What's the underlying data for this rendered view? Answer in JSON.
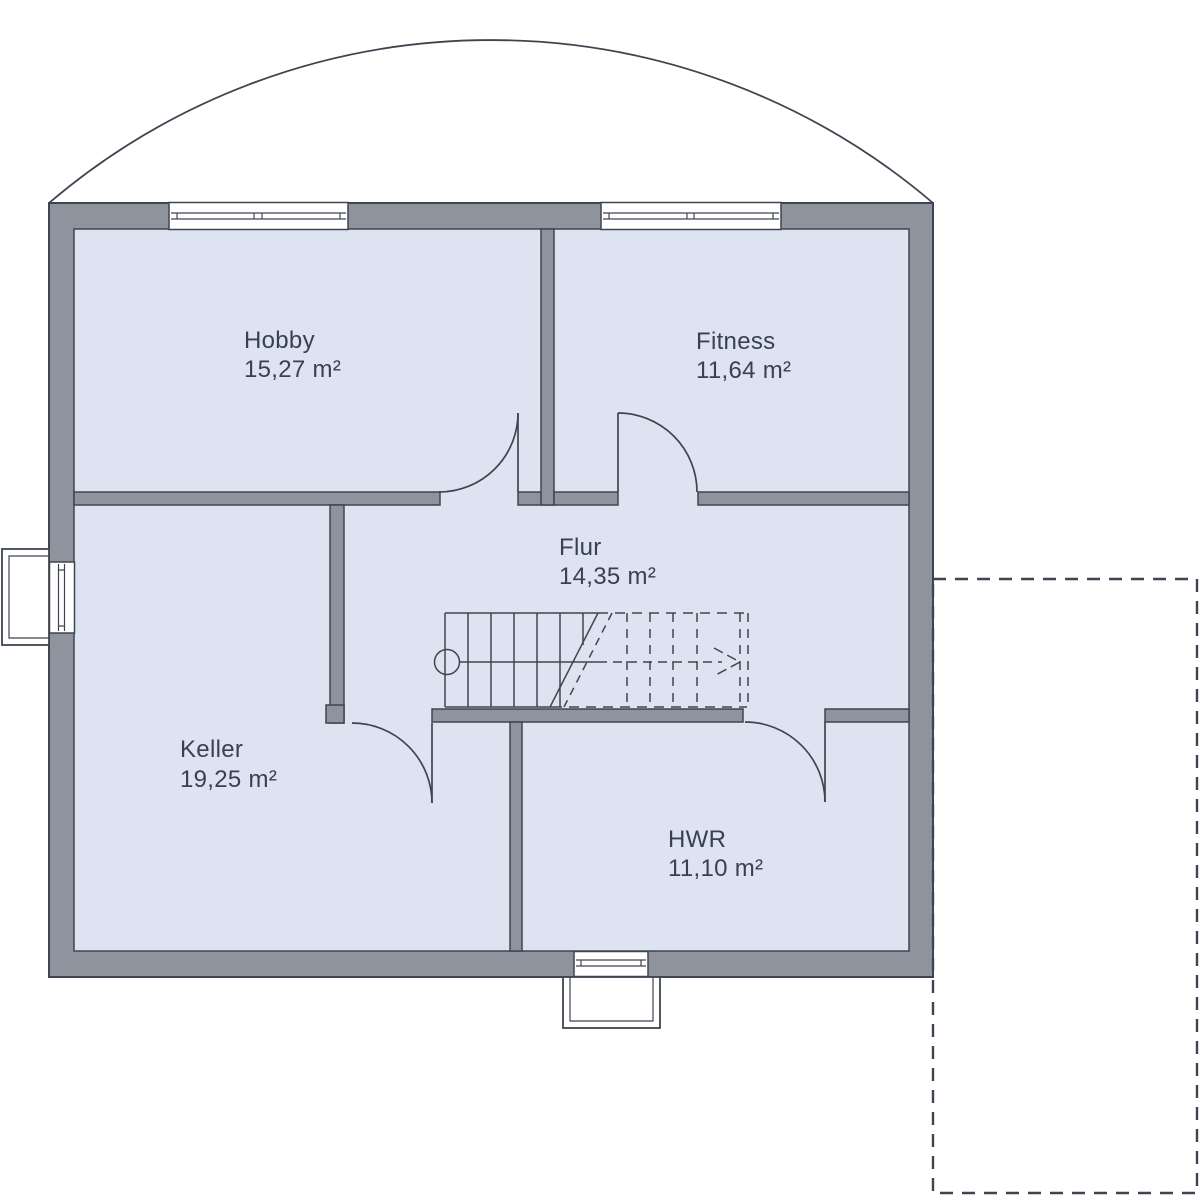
{
  "floorplan": {
    "rooms": [
      {
        "id": "hobby",
        "name": "Hobby",
        "area": "15,27 m²"
      },
      {
        "id": "fitness",
        "name": "Fitness",
        "area": "11,64 m²"
      },
      {
        "id": "flur",
        "name": "Flur",
        "area": "14,35 m²"
      },
      {
        "id": "keller",
        "name": "Keller",
        "area": "19,25 m²"
      },
      {
        "id": "hwr",
        "name": "HWR",
        "area": "11,10 m²"
      }
    ],
    "colors": {
      "wall_fill": "#8e939d",
      "room_fill": "#dde3f1",
      "line": "#3f4550",
      "label_text": "#39414f",
      "background": "#ffffff"
    }
  }
}
